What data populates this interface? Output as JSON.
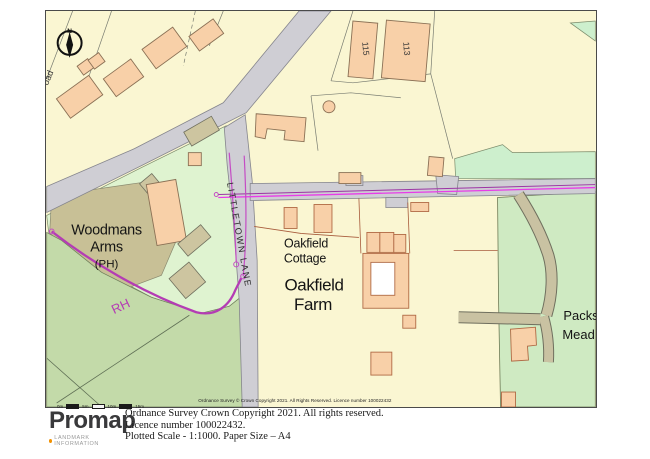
{
  "map": {
    "labels": {
      "north": "N",
      "road_partial": "oad",
      "house_115": "115",
      "house_113": "113",
      "pub_line1": "Woodmans",
      "pub_line2": "Arms",
      "pub_line3": "(PH)",
      "lane": "LITTLETOWN LANE",
      "cottage_line1": "Oakfield",
      "cottage_line2": "Cottage",
      "farm_line1": "Oakfield",
      "farm_line2": "Farm",
      "meadow_line1": "Packs",
      "meadow_line2": "Mead",
      "boundary_marker": "RH"
    },
    "copyright_inline": "Ordnance Survey © Crown Copyright 2021. All Rights Reserved. Licence number 100022432",
    "scalebar": {
      "ticks": [
        "0m",
        "5m",
        "10m",
        "15m"
      ]
    },
    "colors": {
      "paper": "#ffffff",
      "plot_cream": "#FAF6D2",
      "building_peach": "#F8D0A8",
      "building_khaki": "#CDC5A0",
      "pub_plot_khaki": "#C8C096",
      "grass_light": "#DFF3D0",
      "grass_mint": "#CDEFCD",
      "field_green": "#CFEAC2",
      "field_dark_green": "#C3DAA9",
      "road_gray": "#CFCED4",
      "track_khaki": "#C9C2A2",
      "boundary_magenta": "#B43CB4",
      "route_magenta": "#E83CE8",
      "plot_brown": "#A85C3C"
    }
  },
  "footer": {
    "logo": "Promap",
    "logo_sub": "LANDMARK INFORMATION",
    "line1": "Ordnance Survey Crown Copyright 2021. All rights reserved.",
    "line2": "Licence number 100022432.",
    "line3": "Plotted Scale - 1:1000. Paper Size – A4"
  }
}
